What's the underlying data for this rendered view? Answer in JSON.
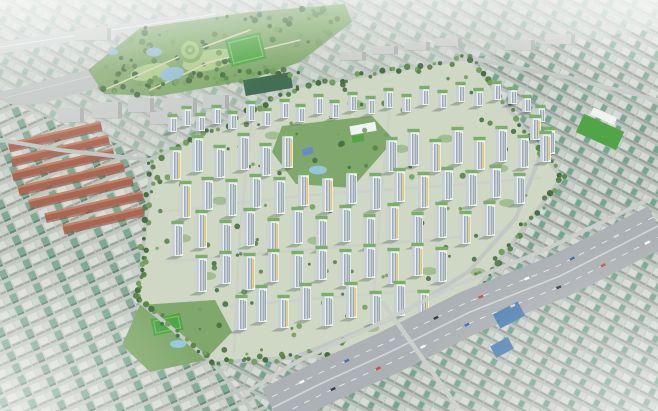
{
  "meta": {
    "description": "Aerial bird's-eye architectural rendering of a large new white high-rise apartment complex with interior parks, bounded by tree-lined roads, set inside dense low-rise city fabric with jade-green roofs; a large landscaped park with sports field, spiral lawn and ponds at top-center; red-brick housing rows at left; a wide multi-lane expressway crossing the lower right; hazy city horizon at the edges.",
    "width": 658,
    "height": 411,
    "visible_text": []
  },
  "colors": {
    "base": "#ccd3cc",
    "fabric_bg_left": "#bfc6be",
    "fabric_bldg_light": "#d8dcd6",
    "fabric_bldg_mid": "#cbd2ca",
    "fabric_roof_teal": "#7ba690",
    "fabric_shadow": "#99a29a",
    "fabric_shadow_dark": "#5c8572",
    "fabric_bg_right": "#b7bfb9",
    "fabric_bldg_r1": "#d4d9d3",
    "fabric_roof_r": "#6fa28c",
    "fabric_bldg_r2": "#c9cfc9",
    "fabric_shadow_r": "#939c95",
    "corridor": "#c5ccc8",
    "rail": "#b9c0bc",
    "park_green": "#7ca566",
    "park_tree_dark": "#3f6a3c",
    "park_tree_mid": "#567f47",
    "park_tree_light": "#6f9c58",
    "park_lawn": "#a9c885",
    "field_green": "#49a23f",
    "field_line": "#7cc36a",
    "pond_blue": "#8fb9d2",
    "pool_blue": "#8ec6dd",
    "ring_light": "#9dc27b",
    "ring_mid": "#7ba75f",
    "roof_dark_green": "#3c6a50",
    "gray_bldg": "#c6cac7",
    "gray_bldg_side": "#a8aeab",
    "brick": "#a8604d",
    "brick_light": "#c17f63",
    "brick_shadow": "#7e4437",
    "complex_ground": "#cdd7c2",
    "greenbelt": "#6a9a5c",
    "tower_face": "#eceff0",
    "tower_side": "#c6cdd4",
    "tower_windows": "#9aa8b4",
    "tower_accent": "#e4c55e",
    "tower_roof": "#74ac62",
    "tower_shadow": "rgba(70,82,74,0.35)",
    "school_white": "#f1f3f2",
    "court_blue": "#5f89c9",
    "expressway": "#a9aeb2",
    "factory_blue": "#4d80b2",
    "haze": "#ffffff",
    "vehicle_colors": [
      "#ffffff",
      "#d2d6d9",
      "#c44d42",
      "#3a6cae",
      "#33363a"
    ]
  },
  "scene": {
    "complex_polygon": [
      [
        150,
        160
      ],
      [
        300,
        86
      ],
      [
        470,
        58
      ],
      [
        563,
        178
      ],
      [
        432,
        350
      ],
      [
        213,
        363
      ],
      [
        136,
        300
      ]
    ],
    "park_polygon": [
      [
        88,
        70
      ],
      [
        140,
        28
      ],
      [
        250,
        12
      ],
      [
        345,
        4
      ],
      [
        352,
        22
      ],
      [
        300,
        62
      ],
      [
        250,
        80
      ],
      [
        160,
        96
      ],
      [
        104,
        94
      ]
    ],
    "central_park_polygon": [
      [
        272,
        152
      ],
      [
        282,
        126
      ],
      [
        372,
        116
      ],
      [
        394,
        140
      ],
      [
        352,
        188
      ],
      [
        296,
        184
      ]
    ],
    "south_park_polygon": [
      [
        140,
        305
      ],
      [
        215,
        300
      ],
      [
        232,
        332
      ],
      [
        205,
        360
      ],
      [
        150,
        372
      ],
      [
        122,
        345
      ]
    ],
    "towers_tall": [
      [
        170,
        180,
        30
      ],
      [
        192,
        172,
        34
      ],
      [
        214,
        178,
        30
      ],
      [
        238,
        170,
        34
      ],
      [
        260,
        176,
        30
      ],
      [
        282,
        168,
        32
      ],
      [
        386,
        172,
        32
      ],
      [
        408,
        166,
        34
      ],
      [
        430,
        172,
        30
      ],
      [
        452,
        164,
        34
      ],
      [
        474,
        170,
        30
      ],
      [
        496,
        162,
        33
      ],
      [
        518,
        168,
        30
      ],
      [
        540,
        162,
        28
      ],
      [
        180,
        218,
        34
      ],
      [
        202,
        210,
        30
      ],
      [
        226,
        216,
        34
      ],
      [
        250,
        208,
        31
      ],
      [
        274,
        214,
        34
      ],
      [
        298,
        206,
        31
      ],
      [
        322,
        212,
        34
      ],
      [
        346,
        204,
        31
      ],
      [
        370,
        210,
        34
      ],
      [
        394,
        202,
        31
      ],
      [
        418,
        208,
        33
      ],
      [
        442,
        200,
        30
      ],
      [
        466,
        206,
        33
      ],
      [
        490,
        198,
        30
      ],
      [
        514,
        204,
        28
      ],
      [
        172,
        256,
        32
      ],
      [
        196,
        248,
        35
      ],
      [
        220,
        254,
        31
      ],
      [
        244,
        246,
        35
      ],
      [
        268,
        252,
        31
      ],
      [
        292,
        244,
        34
      ],
      [
        316,
        250,
        31
      ],
      [
        340,
        242,
        34
      ],
      [
        364,
        248,
        31
      ],
      [
        388,
        240,
        34
      ],
      [
        412,
        246,
        31
      ],
      [
        436,
        238,
        33
      ],
      [
        460,
        244,
        30
      ],
      [
        484,
        236,
        32
      ],
      [
        196,
        292,
        34
      ],
      [
        220,
        284,
        30
      ],
      [
        244,
        290,
        34
      ],
      [
        268,
        282,
        30
      ],
      [
        292,
        288,
        34
      ],
      [
        316,
        280,
        31
      ],
      [
        340,
        286,
        34
      ],
      [
        364,
        278,
        31
      ],
      [
        388,
        284,
        33
      ],
      [
        412,
        276,
        30
      ],
      [
        436,
        282,
        32
      ],
      [
        236,
        330,
        32
      ],
      [
        256,
        322,
        34
      ],
      [
        278,
        328,
        30
      ],
      [
        300,
        320,
        34
      ],
      [
        322,
        326,
        30
      ],
      [
        346,
        318,
        33
      ],
      [
        370,
        324,
        30
      ],
      [
        394,
        316,
        32
      ],
      [
        418,
        322,
        29
      ],
      [
        530,
        140,
        22
      ],
      [
        544,
        154,
        24
      ]
    ],
    "towers_low": [
      [
        168,
        132,
        15
      ],
      [
        182,
        126,
        17
      ],
      [
        196,
        131,
        15
      ],
      [
        212,
        124,
        16
      ],
      [
        228,
        129,
        15
      ],
      [
        246,
        121,
        17
      ],
      [
        262,
        126,
        15
      ],
      [
        280,
        118,
        16
      ],
      [
        296,
        122,
        15
      ],
      [
        314,
        114,
        17
      ],
      [
        330,
        118,
        15
      ],
      [
        348,
        111,
        16
      ],
      [
        366,
        114,
        15
      ],
      [
        384,
        108,
        17
      ],
      [
        402,
        112,
        15
      ],
      [
        420,
        105,
        16
      ],
      [
        438,
        108,
        15
      ],
      [
        456,
        102,
        17
      ],
      [
        474,
        106,
        15
      ],
      [
        492,
        100,
        16
      ],
      [
        508,
        104,
        14
      ],
      [
        522,
        112,
        14
      ],
      [
        536,
        122,
        14
      ]
    ],
    "brick_rows": [
      [
        55,
        136,
        95
      ],
      [
        60,
        150,
        100
      ],
      [
        63,
        164,
        104
      ],
      [
        71,
        178,
        108
      ],
      [
        81,
        192,
        106
      ],
      [
        94,
        206,
        100
      ],
      [
        106,
        219,
        88
      ]
    ],
    "gray_buildings": [
      [
        58,
        108,
        26,
        14
      ],
      [
        92,
        102,
        30,
        16
      ],
      [
        128,
        98,
        26,
        14
      ],
      [
        163,
        98,
        34,
        18
      ],
      [
        203,
        95,
        26,
        13
      ],
      [
        150,
        112,
        22,
        12
      ],
      [
        75,
        28,
        36,
        12
      ],
      [
        340,
        52,
        26,
        8
      ],
      [
        372,
        46,
        26,
        8
      ],
      [
        404,
        42,
        26,
        8
      ],
      [
        436,
        38,
        26,
        8
      ],
      [
        505,
        40,
        30,
        10
      ],
      [
        545,
        34,
        30,
        10
      ]
    ],
    "tree_lines": [
      [
        [
          152,
          160
        ],
        [
          300,
          86
        ],
        [
          470,
          58
        ]
      ],
      [
        [
          470,
          58
        ],
        [
          562,
          178
        ]
      ],
      [
        [
          562,
          178
        ],
        [
          432,
          348
        ]
      ],
      [
        [
          432,
          348
        ],
        [
          213,
          363
        ]
      ],
      [
        [
          213,
          363
        ],
        [
          138,
          300
        ],
        [
          152,
          162
        ]
      ],
      [
        [
          104,
          92
        ],
        [
          200,
          76
        ],
        [
          300,
          72
        ]
      ],
      [
        [
          143,
          250
        ],
        [
          141,
          298
        ]
      ]
    ],
    "inner_paths": [
      [
        [
          160,
          212
        ],
        [
          300,
          196
        ],
        [
          440,
          186
        ],
        [
          540,
          178
        ]
      ],
      [
        [
          165,
          262
        ],
        [
          300,
          250
        ],
        [
          430,
          240
        ],
        [
          505,
          232
        ]
      ],
      [
        [
          185,
          310
        ],
        [
          300,
          300
        ],
        [
          400,
          292
        ],
        [
          452,
          290
        ]
      ],
      [
        [
          252,
          118
        ],
        [
          240,
          230
        ],
        [
          234,
          352
        ]
      ],
      [
        [
          390,
          104
        ],
        [
          380,
          210
        ],
        [
          372,
          322
        ]
      ]
    ],
    "boundary_roads": [
      [
        [
          150,
          160
        ],
        [
          300,
          86
        ],
        [
          470,
          58
        ]
      ],
      [
        [
          470,
          58
        ],
        [
          562,
          178
        ]
      ],
      [
        [
          562,
          178
        ],
        [
          432,
          348
        ]
      ],
      [
        [
          432,
          348
        ],
        [
          213,
          363
        ]
      ],
      [
        [
          213,
          363
        ],
        [
          138,
          300
        ],
        [
          152,
          162
        ]
      ],
      [
        [
          470,
          58
        ],
        [
          570,
          78
        ],
        [
          658,
          100
        ]
      ],
      [
        [
          213,
          363
        ],
        [
          252,
          411
        ]
      ],
      [
        [
          150,
          160
        ],
        [
          60,
          150
        ],
        [
          0,
          140
        ]
      ],
      [
        [
          543,
          148
        ],
        [
          516,
          218
        ],
        [
          468,
          272
        ],
        [
          398,
          316
        ],
        [
          300,
          355
        ]
      ]
    ],
    "expressway": {
      "centerline": [
        [
          658,
          226
        ],
        [
          560,
          276
        ],
        [
          470,
          312
        ],
        [
          390,
          352
        ],
        [
          320,
          384
        ],
        [
          272,
          408
        ]
      ],
      "width": 44,
      "vehicle_count": 16,
      "frontage": [
        [
          648,
          200
        ],
        [
          540,
          252
        ],
        [
          450,
          288
        ],
        [
          370,
          328
        ],
        [
          300,
          360
        ],
        [
          250,
          390
        ]
      ],
      "overpass": [
        [
          383,
          303
        ],
        [
          458,
          408
        ]
      ]
    },
    "blue_factories": [
      [
        495,
        307,
        28,
        16
      ],
      [
        492,
        341,
        20,
        13
      ]
    ],
    "counts": {
      "complex_trees": 120,
      "park_trees": 90,
      "courtyards": 14
    }
  }
}
